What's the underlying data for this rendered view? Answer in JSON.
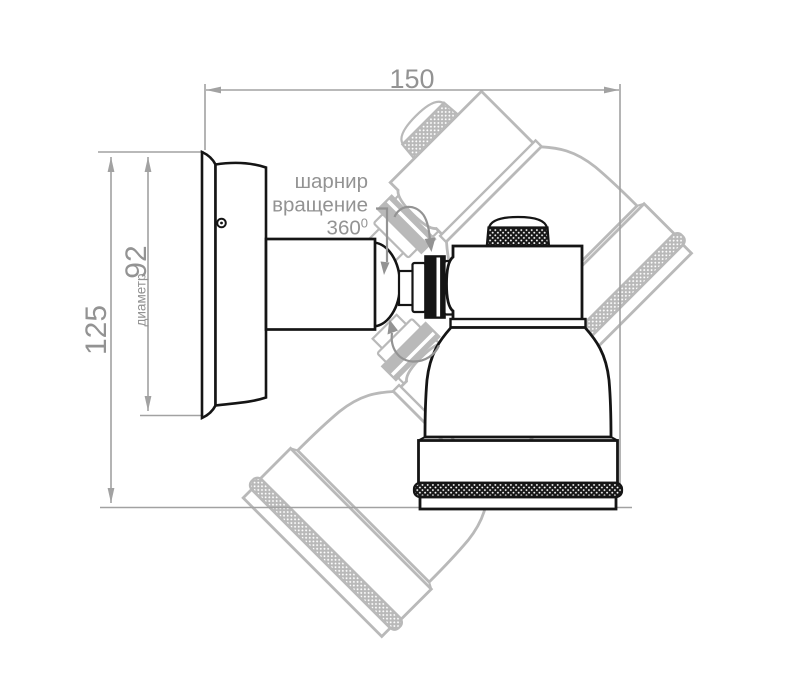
{
  "dimensions": {
    "width_mm": "150",
    "height_mm": "125",
    "plate_diameter_caption": "диаметр",
    "plate_diameter_mm": "92"
  },
  "hinge_note": {
    "line1": "шарнир",
    "line2": "вращение",
    "angle_value": "360",
    "angle_superscript": "0"
  },
  "colors": {
    "line_black": "#151515",
    "dim_gray": "#a2a2a2",
    "text_gray": "#939393",
    "ghost_gray": "#b9b9b9",
    "bg": "#ffffff"
  }
}
